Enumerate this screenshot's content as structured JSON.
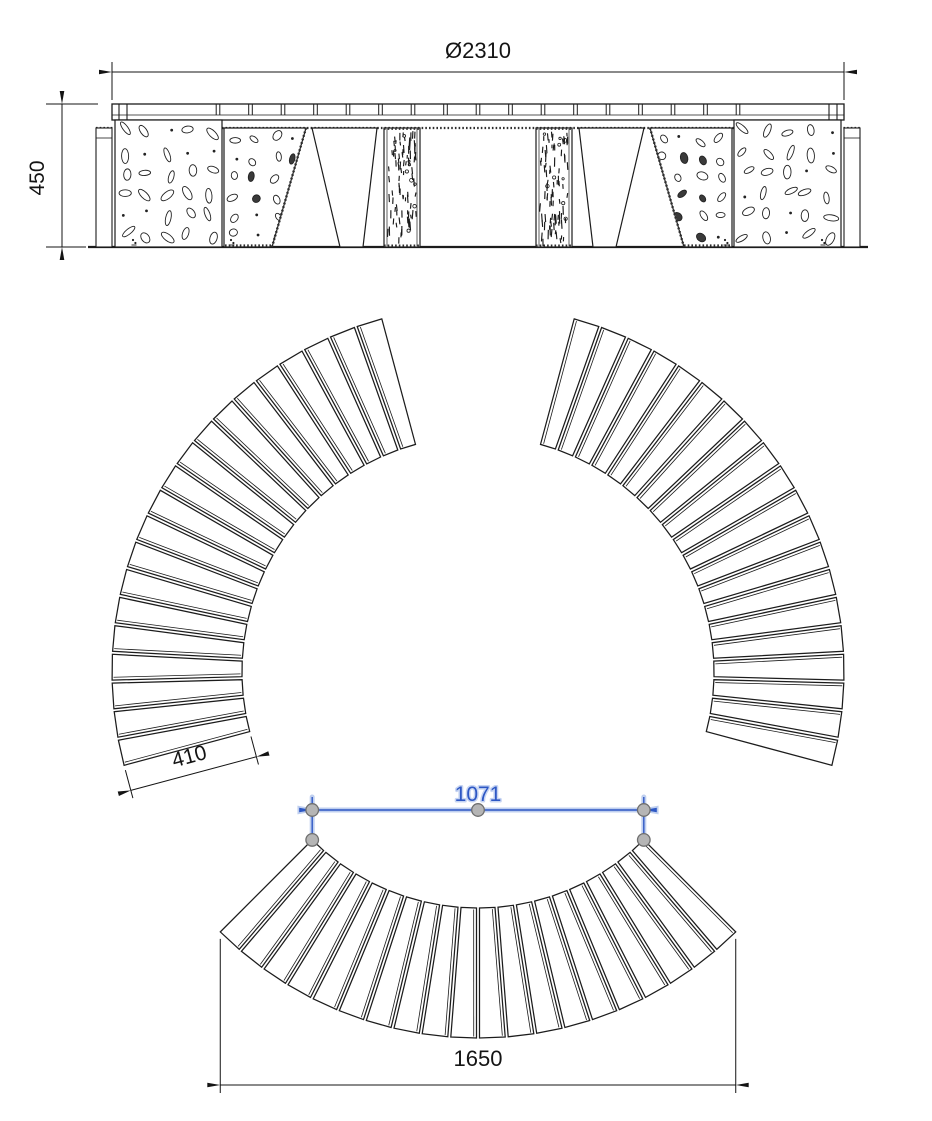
{
  "drawing": {
    "type": "technical-drawing",
    "subject": "circular-slatted-bench",
    "views": {
      "front_elevation": {
        "name": "front elevation"
      },
      "plan": {
        "name": "plan view of bench ring"
      },
      "segment_plan": {
        "name": "bench segment plan"
      }
    },
    "dimensions": {
      "diameter": {
        "label": "Ø2310",
        "value": 2310
      },
      "height": {
        "label": "450",
        "value": 450
      },
      "slat_length": {
        "label": "410",
        "value": 410
      },
      "segment_chord": {
        "label": "1071",
        "value": 1071,
        "selected": true
      },
      "segment_width": {
        "label": "1650",
        "value": 1650
      }
    },
    "style": {
      "background": "#ffffff",
      "line_color": "#1c1c1c",
      "dim_color": "#141414",
      "selected_color": "#2d57c4",
      "selected_glow": "#bfcfef",
      "grip_fill": "#b5b5b5",
      "grip_stroke": "#6f6f6f"
    },
    "geometry": {
      "ring_center": {
        "x": 478,
        "y": 672
      },
      "outer_radius_px": 366,
      "inner_radius_px": 236,
      "slats_per_segment": 20,
      "segment_span_deg": 90,
      "segments": [
        {
          "name": "left",
          "start_deg": 105
        },
        {
          "name": "right",
          "start_deg": -15
        },
        {
          "name": "bottom",
          "start_deg": 225
        }
      ],
      "gap_px": 3
    }
  }
}
